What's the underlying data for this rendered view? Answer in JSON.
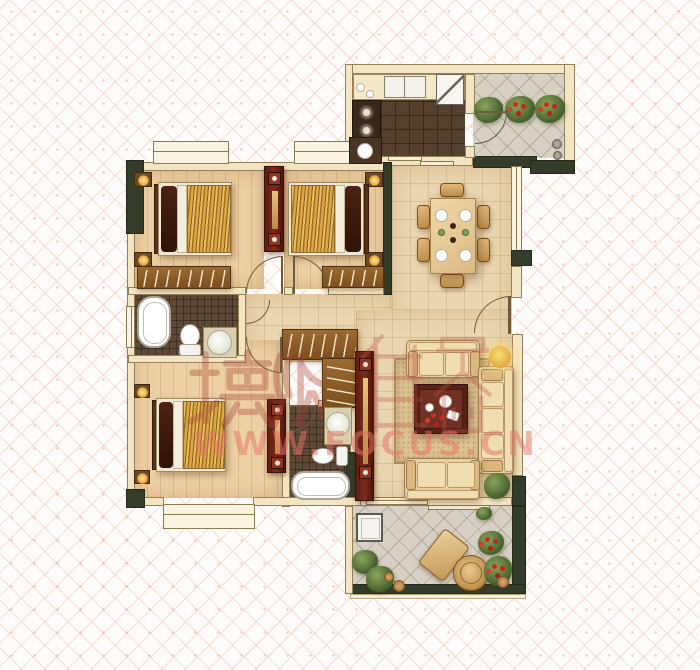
{
  "document": {
    "kind": "apartment floor plan scan",
    "background": "pink diamond lattice wallpaper"
  },
  "watermark": {
    "brand": "搜狐",
    "logo_text": "焦点",
    "url": "WWW.FOCUS.CN",
    "color": "#d9716a"
  },
  "palette": {
    "wall_cream": "#f3e5c2",
    "wall_dark_olive": "#343c2a",
    "wood_floor": "#edd1a5",
    "tile_floor": "#ead6b0",
    "kitchen_tile": "#55402e",
    "bath_tile": "#5e4836",
    "balcony_tile": "#d7d0c4",
    "cabinet_red": "#6e2416",
    "blanket_gold": "#d9a843",
    "sofa_tan": "#e9cf9f",
    "plant_green": "#49632f",
    "flower_red": "#cf2a20",
    "lamp_yellow": "#f0c84e",
    "lattice_pink": "#eec0b0"
  },
  "floor_plan": {
    "rooms": [
      {
        "name": "bedroom-top-left",
        "furniture": [
          "double-bed",
          "nightstand-lamps",
          "wardrobe",
          "bay-window"
        ]
      },
      {
        "name": "bedroom-top-middle",
        "furniture": [
          "double-bed",
          "nightstand-lamps",
          "wardrobe",
          "bay-window"
        ]
      },
      {
        "name": "kitchen",
        "furniture": [
          "counter",
          "sink",
          "cooktop",
          "fridge"
        ]
      },
      {
        "name": "north-balcony",
        "furniture": [
          "planter-boxes",
          "pots"
        ]
      },
      {
        "name": "dining-room",
        "furniture": [
          "dining-table",
          "six-chairs",
          "place-settings"
        ]
      },
      {
        "name": "bathroom-ensuite",
        "furniture": [
          "bathtub",
          "toilet",
          "wash-basin"
        ]
      },
      {
        "name": "hallway",
        "furniture": [
          "walk-in-closet"
        ]
      },
      {
        "name": "bedroom-bottom-left",
        "furniture": [
          "double-bed",
          "nightstand-lamps",
          "tv-cabinet",
          "bay-window"
        ]
      },
      {
        "name": "bathroom-main",
        "furniture": [
          "bathtub",
          "toilet",
          "wash-basin"
        ]
      },
      {
        "name": "living-room",
        "furniture": [
          "sofa-set",
          "coffee-table",
          "rug",
          "floor-lamp",
          "tv-cabinet",
          "plant"
        ]
      },
      {
        "name": "south-balcony",
        "furniture": [
          "washing-machine",
          "lounge-chair",
          "round-table",
          "plants"
        ]
      }
    ]
  }
}
